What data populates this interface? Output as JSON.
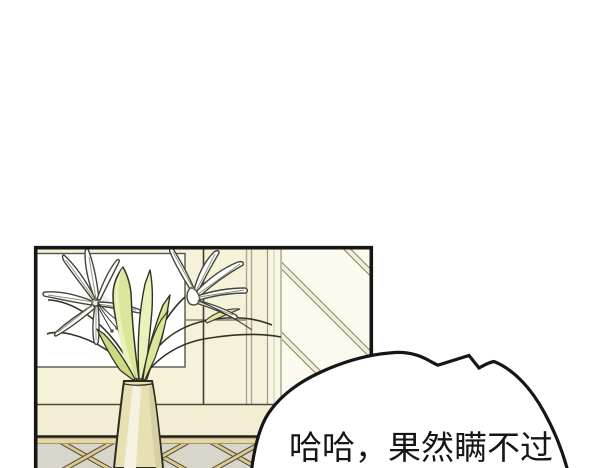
{
  "bubble": {
    "text": "哈哈，果然瞒不过"
  },
  "scene": {
    "description": "webtoon comic panel: white lilies in a tall vase on a console table in front of a wall with a white window and diagonal lattice",
    "elements": [
      "comic-panel",
      "window",
      "lattice-wall",
      "lily-bouquet",
      "vase",
      "console-table",
      "speech-bubble"
    ]
  },
  "colors": {
    "page_bg": "#ffffff",
    "ink": "#161616",
    "wall": "#f6f2da",
    "window_white": "#ffffff",
    "lattice_bg": "#fcfaee",
    "lattice_batten": "#f2eed6",
    "leaf": "#dde59a",
    "leaf_light": "#ebf1bb",
    "leaf_dark": "#cdd985",
    "vase": "#e7e0b2",
    "vase_highlight": "#f5f2e1",
    "vase_shadow": "#d7d0a2",
    "tabletop": "#f2edd3",
    "rail": "#e5d7a3",
    "apron": "#d8d6cb",
    "batten": "#dcc98f",
    "petal": "#ffffff",
    "line_gray": "#a8a799",
    "outline": "#45453a"
  }
}
